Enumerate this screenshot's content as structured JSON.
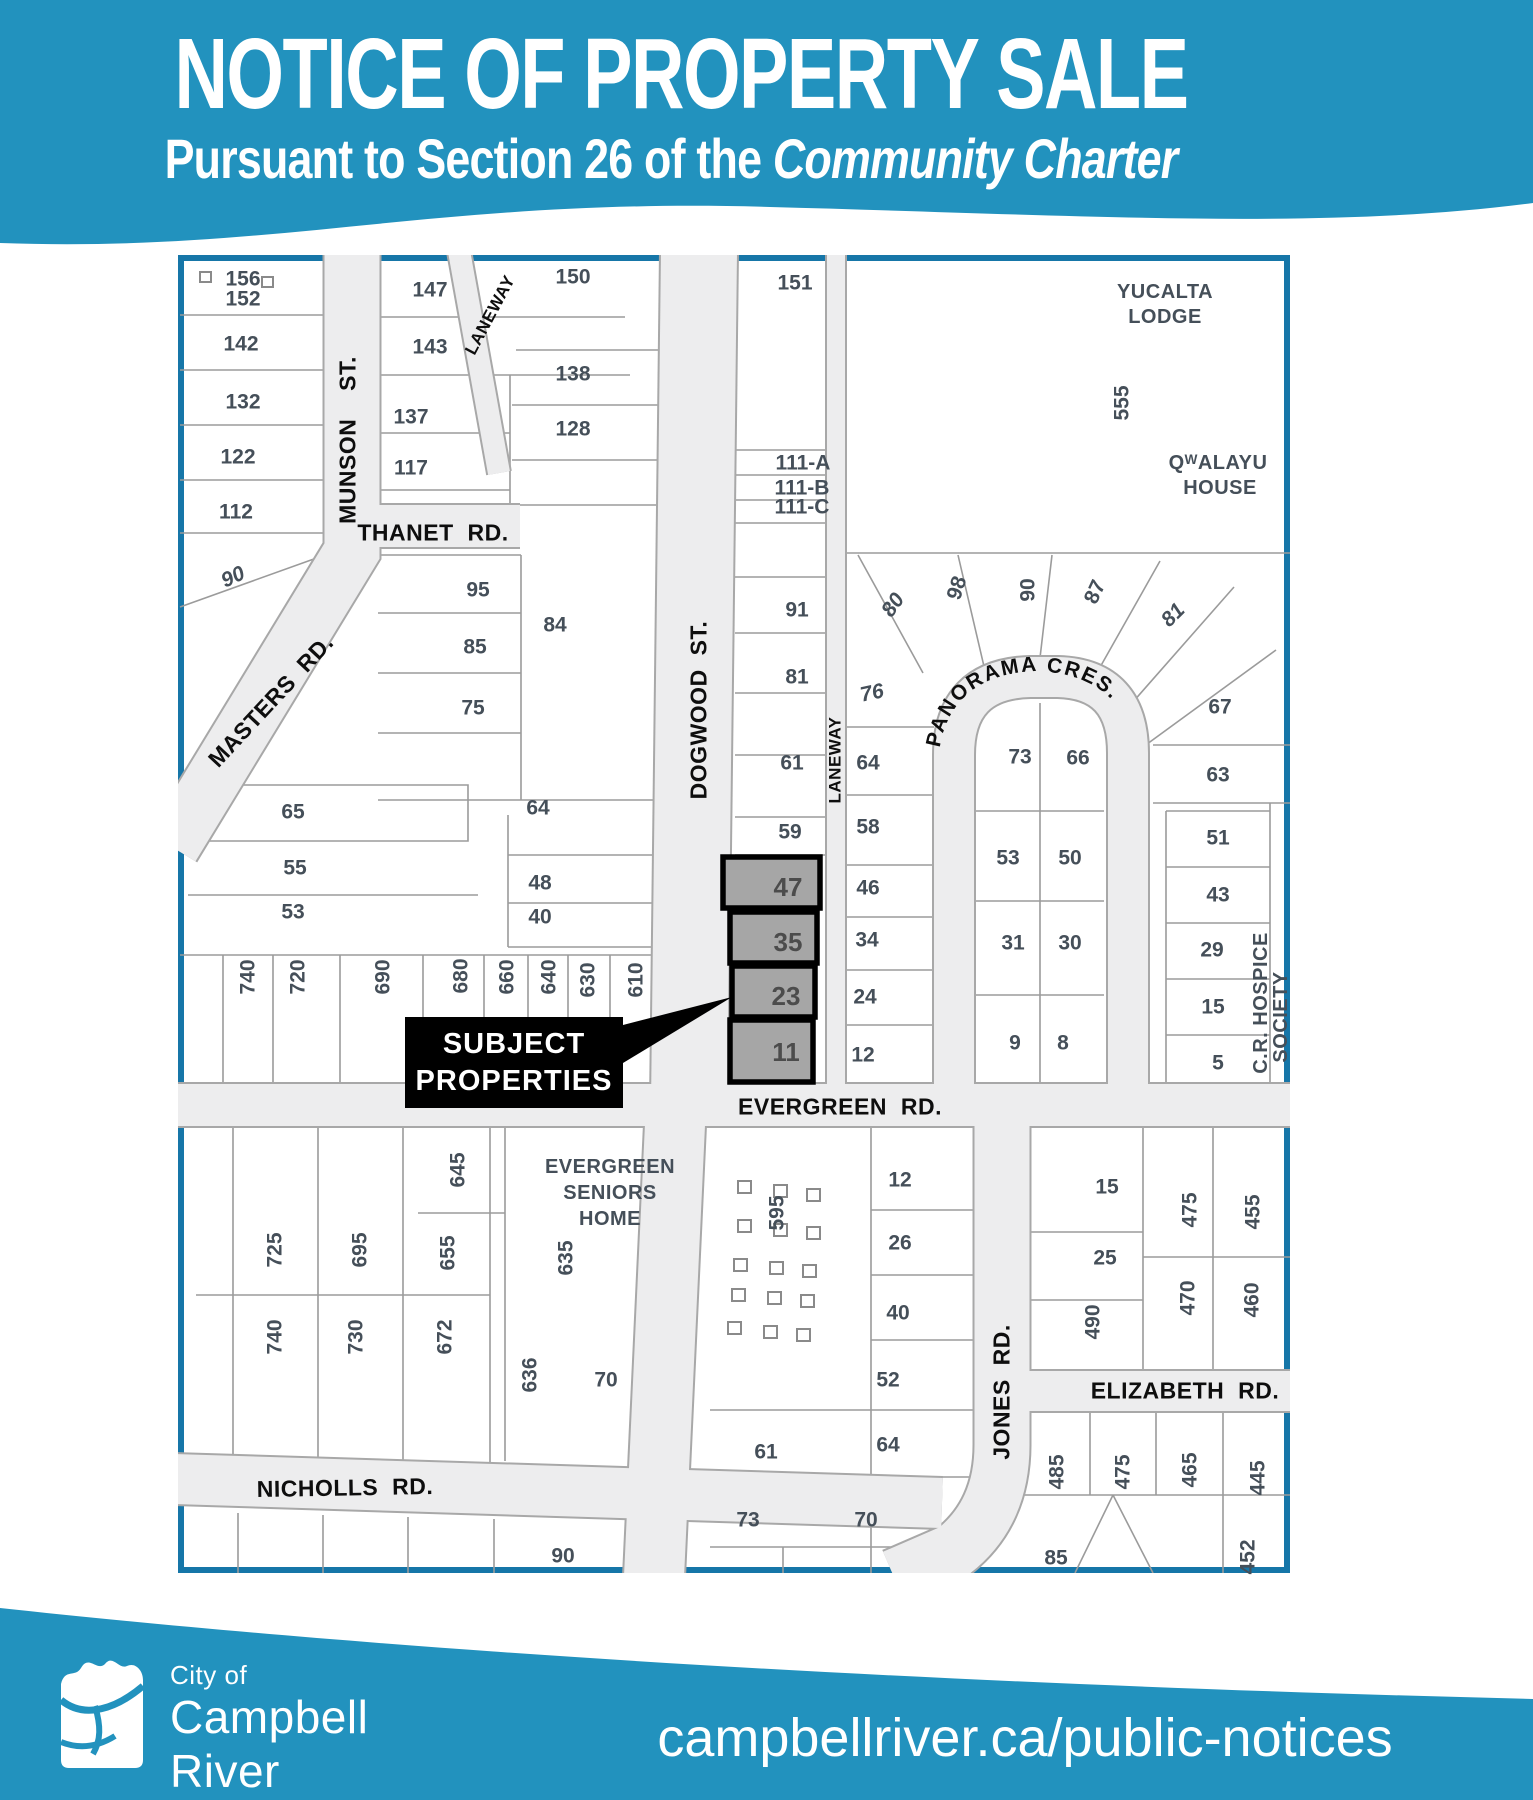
{
  "header": {
    "title": "NOTICE OF PROPERTY SALE",
    "subtitle_prefix": "Pursuant to Section 26 of the ",
    "subtitle_italic": "Community Charter"
  },
  "colors": {
    "teal": "#2292be",
    "map_border": "#1676a8",
    "street_fill": "#ededee",
    "subject_fill": "#a6a6a6",
    "lot_number_color": "#454f59"
  },
  "map": {
    "callout": {
      "line1": "SUBJECT",
      "line2": "PROPERTIES"
    },
    "panorama_label": "PANORAMA CRES.",
    "subject_lot_numbers": [
      "47",
      "35",
      "23",
      "11"
    ],
    "labels": [
      {
        "text": "MUNSON  ST.",
        "x": 170,
        "y": 185,
        "rot": -90,
        "kind": "street"
      },
      {
        "text": "LANEWAY",
        "x": 312,
        "y": 60,
        "rot": -62,
        "kind": "streetsm"
      },
      {
        "text": "THANET RD.",
        "x": 255,
        "y": 278,
        "kind": "street"
      },
      {
        "text": "MASTERS RD.",
        "x": 93,
        "y": 446,
        "rot": -47,
        "kind": "street"
      },
      {
        "text": "DOGWOOD ST.",
        "x": 521,
        "y": 455,
        "rot": -90,
        "kind": "street"
      },
      {
        "text": "LANEWAY",
        "x": 657,
        "y": 505,
        "rot": -90,
        "kind": "streetsm"
      },
      {
        "text": "EVERGREEN RD.",
        "x": 662,
        "y": 852,
        "kind": "street"
      },
      {
        "text": "NICHOLLS RD.",
        "x": 167,
        "y": 1233,
        "rot": -1,
        "kind": "street"
      },
      {
        "text": "JONES RD.",
        "x": 824,
        "y": 1137,
        "rot": -90,
        "kind": "street"
      },
      {
        "text": "ELIZABETH RD.",
        "x": 1007,
        "y": 1136,
        "kind": "street"
      },
      {
        "text": "YUCALTA",
        "x": 987,
        "y": 37,
        "kind": "landmark"
      },
      {
        "text": "LODGE",
        "x": 987,
        "y": 62,
        "kind": "landmark"
      },
      {
        "text": "QᵂALAYU",
        "x": 1040,
        "y": 208,
        "kind": "landmark"
      },
      {
        "text": "HOUSE",
        "x": 1042,
        "y": 233,
        "kind": "landmark"
      },
      {
        "text": "EVERGREEN",
        "x": 432,
        "y": 912,
        "kind": "landmark"
      },
      {
        "text": "SENIORS",
        "x": 432,
        "y": 938,
        "kind": "landmark"
      },
      {
        "text": "HOME",
        "x": 432,
        "y": 964,
        "kind": "landmark"
      },
      {
        "text": "C.R. HOSPICE",
        "x": 1083,
        "y": 748,
        "rot": -90,
        "kind": "landmark"
      },
      {
        "text": "SOCIETY",
        "x": 1103,
        "y": 762,
        "rot": -90,
        "kind": "landmark"
      },
      {
        "text": "156",
        "x": 65,
        "y": 24,
        "kind": "lot"
      },
      {
        "text": "152",
        "x": 65,
        "y": 44,
        "kind": "lot"
      },
      {
        "text": "142",
        "x": 63,
        "y": 89,
        "kind": "lot"
      },
      {
        "text": "132",
        "x": 65,
        "y": 147,
        "kind": "lot"
      },
      {
        "text": "122",
        "x": 60,
        "y": 202,
        "kind": "lot"
      },
      {
        "text": "112",
        "x": 58,
        "y": 257,
        "kind": "lot"
      },
      {
        "text": "90",
        "x": 55,
        "y": 322,
        "rot": -25,
        "kind": "ilot"
      },
      {
        "text": "147",
        "x": 252,
        "y": 35,
        "kind": "lot"
      },
      {
        "text": "143",
        "x": 252,
        "y": 92,
        "kind": "lot"
      },
      {
        "text": "137",
        "x": 233,
        "y": 162,
        "kind": "lot"
      },
      {
        "text": "117",
        "x": 233,
        "y": 213,
        "kind": "lot"
      },
      {
        "text": "150",
        "x": 395,
        "y": 22,
        "kind": "lot"
      },
      {
        "text": "138",
        "x": 395,
        "y": 119,
        "kind": "lot"
      },
      {
        "text": "128",
        "x": 395,
        "y": 174,
        "kind": "lot"
      },
      {
        "text": "151",
        "x": 617,
        "y": 28,
        "kind": "lot"
      },
      {
        "text": "111-A",
        "x": 625,
        "y": 208,
        "kind": "lot"
      },
      {
        "text": "111-B",
        "x": 624,
        "y": 233,
        "kind": "lot"
      },
      {
        "text": "111-C",
        "x": 624,
        "y": 252,
        "kind": "lot"
      },
      {
        "text": "555",
        "x": 944,
        "y": 148,
        "rot": -90,
        "kind": "lot"
      },
      {
        "text": "95",
        "x": 300,
        "y": 335,
        "kind": "lot"
      },
      {
        "text": "85",
        "x": 297,
        "y": 392,
        "kind": "lot"
      },
      {
        "text": "75",
        "x": 295,
        "y": 453,
        "kind": "lot"
      },
      {
        "text": "84",
        "x": 377,
        "y": 370,
        "kind": "lot"
      },
      {
        "text": "65",
        "x": 115,
        "y": 557,
        "kind": "lot"
      },
      {
        "text": "55",
        "x": 117,
        "y": 613,
        "kind": "lot"
      },
      {
        "text": "53",
        "x": 115,
        "y": 657,
        "kind": "lot"
      },
      {
        "text": "64",
        "x": 360,
        "y": 553,
        "kind": "lot"
      },
      {
        "text": "48",
        "x": 362,
        "y": 628,
        "kind": "lot"
      },
      {
        "text": "40",
        "x": 362,
        "y": 662,
        "kind": "lot"
      },
      {
        "text": "91",
        "x": 619,
        "y": 355,
        "kind": "lot"
      },
      {
        "text": "81",
        "x": 619,
        "y": 422,
        "kind": "lot"
      },
      {
        "text": "61",
        "x": 614,
        "y": 508,
        "kind": "lot"
      },
      {
        "text": "59",
        "x": 612,
        "y": 577,
        "kind": "lot"
      },
      {
        "text": "80",
        "x": 715,
        "y": 350,
        "rot": -55,
        "kind": "ilot"
      },
      {
        "text": "76",
        "x": 694,
        "y": 438,
        "rot": -12,
        "kind": "ilot"
      },
      {
        "text": "64",
        "x": 690,
        "y": 508,
        "kind": "lot"
      },
      {
        "text": "58",
        "x": 690,
        "y": 572,
        "kind": "lot"
      },
      {
        "text": "46",
        "x": 690,
        "y": 633,
        "kind": "lot"
      },
      {
        "text": "34",
        "x": 689,
        "y": 685,
        "kind": "lot"
      },
      {
        "text": "24",
        "x": 687,
        "y": 742,
        "kind": "lot"
      },
      {
        "text": "12",
        "x": 685,
        "y": 800,
        "kind": "lot"
      },
      {
        "text": "47",
        "x": 610,
        "y": 632,
        "kind": "subject"
      },
      {
        "text": "35",
        "x": 610,
        "y": 687,
        "kind": "subject"
      },
      {
        "text": "23",
        "x": 608,
        "y": 741,
        "kind": "subject"
      },
      {
        "text": "11",
        "x": 608,
        "y": 797,
        "kind": "subject"
      },
      {
        "text": "98",
        "x": 779,
        "y": 333,
        "rot": -72,
        "kind": "lot"
      },
      {
        "text": "90",
        "x": 850,
        "y": 335,
        "rot": -90,
        "kind": "lot"
      },
      {
        "text": "87",
        "x": 917,
        "y": 337,
        "rot": -65,
        "kind": "lot"
      },
      {
        "text": "81",
        "x": 995,
        "y": 360,
        "rot": -45,
        "kind": "ilot"
      },
      {
        "text": "67",
        "x": 1042,
        "y": 452,
        "kind": "lot"
      },
      {
        "text": "63",
        "x": 1040,
        "y": 520,
        "kind": "lot"
      },
      {
        "text": "73",
        "x": 842,
        "y": 502,
        "kind": "lot"
      },
      {
        "text": "66",
        "x": 900,
        "y": 503,
        "kind": "lot"
      },
      {
        "text": "53",
        "x": 830,
        "y": 603,
        "kind": "lot"
      },
      {
        "text": "50",
        "x": 892,
        "y": 603,
        "kind": "lot"
      },
      {
        "text": "31",
        "x": 835,
        "y": 688,
        "kind": "lot"
      },
      {
        "text": "30",
        "x": 892,
        "y": 688,
        "kind": "lot"
      },
      {
        "text": "9",
        "x": 837,
        "y": 788,
        "kind": "lot"
      },
      {
        "text": "8",
        "x": 885,
        "y": 788,
        "kind": "lot"
      },
      {
        "text": "51",
        "x": 1040,
        "y": 583,
        "kind": "lot"
      },
      {
        "text": "43",
        "x": 1040,
        "y": 640,
        "kind": "lot"
      },
      {
        "text": "29",
        "x": 1034,
        "y": 695,
        "kind": "lot"
      },
      {
        "text": "15",
        "x": 1035,
        "y": 752,
        "kind": "lot"
      },
      {
        "text": "5",
        "x": 1040,
        "y": 808,
        "kind": "lot"
      },
      {
        "text": "740",
        "x": 70,
        "y": 722,
        "rot": -90,
        "kind": "lot"
      },
      {
        "text": "720",
        "x": 120,
        "y": 722,
        "rot": -90,
        "kind": "lot"
      },
      {
        "text": "690",
        "x": 205,
        "y": 722,
        "rot": -90,
        "kind": "lot"
      },
      {
        "text": "680",
        "x": 283,
        "y": 721,
        "rot": -90,
        "kind": "lot"
      },
      {
        "text": "660",
        "x": 329,
        "y": 722,
        "rot": -90,
        "kind": "lot"
      },
      {
        "text": "640",
        "x": 371,
        "y": 722,
        "rot": -90,
        "kind": "lot"
      },
      {
        "text": "630",
        "x": 410,
        "y": 725,
        "rot": -90,
        "kind": "lot"
      },
      {
        "text": "610",
        "x": 458,
        "y": 725,
        "rot": -90,
        "kind": "lot"
      },
      {
        "text": "645",
        "x": 280,
        "y": 915,
        "rot": -90,
        "kind": "lot"
      },
      {
        "text": "635",
        "x": 388,
        "y": 1003,
        "rot": -90,
        "kind": "lot"
      },
      {
        "text": "725",
        "x": 97,
        "y": 995,
        "rot": -90,
        "kind": "lot"
      },
      {
        "text": "695",
        "x": 182,
        "y": 995,
        "rot": -90,
        "kind": "lot"
      },
      {
        "text": "655",
        "x": 270,
        "y": 998,
        "rot": -90,
        "kind": "lot"
      },
      {
        "text": "740",
        "x": 97,
        "y": 1082,
        "rot": -90,
        "kind": "lot"
      },
      {
        "text": "730",
        "x": 178,
        "y": 1082,
        "rot": -90,
        "kind": "lot"
      },
      {
        "text": "672",
        "x": 267,
        "y": 1082,
        "rot": -90,
        "kind": "lot"
      },
      {
        "text": "636",
        "x": 352,
        "y": 1120,
        "rot": -90,
        "kind": "lot"
      },
      {
        "text": "70",
        "x": 428,
        "y": 1125,
        "kind": "lot"
      },
      {
        "text": "90",
        "x": 385,
        "y": 1301,
        "kind": "lot"
      },
      {
        "text": "595",
        "x": 599,
        "y": 958,
        "rot": -90,
        "kind": "lot"
      },
      {
        "text": "12",
        "x": 722,
        "y": 925,
        "kind": "lot"
      },
      {
        "text": "26",
        "x": 722,
        "y": 988,
        "kind": "lot"
      },
      {
        "text": "40",
        "x": 720,
        "y": 1058,
        "kind": "lot"
      },
      {
        "text": "52",
        "x": 710,
        "y": 1125,
        "kind": "lot"
      },
      {
        "text": "64",
        "x": 710,
        "y": 1190,
        "kind": "lot"
      },
      {
        "text": "61",
        "x": 588,
        "y": 1197,
        "kind": "lot"
      },
      {
        "text": "73",
        "x": 570,
        "y": 1265,
        "kind": "lot"
      },
      {
        "text": "70",
        "x": 688,
        "y": 1265,
        "kind": "lot"
      },
      {
        "text": "15",
        "x": 929,
        "y": 932,
        "kind": "lot"
      },
      {
        "text": "25",
        "x": 927,
        "y": 1003,
        "kind": "lot"
      },
      {
        "text": "490",
        "x": 915,
        "y": 1067,
        "rot": -90,
        "kind": "lot"
      },
      {
        "text": "475",
        "x": 1012,
        "y": 955,
        "rot": -90,
        "kind": "lot"
      },
      {
        "text": "455",
        "x": 1075,
        "y": 957,
        "rot": -90,
        "kind": "lot"
      },
      {
        "text": "470",
        "x": 1010,
        "y": 1043,
        "rot": -90,
        "kind": "lot"
      },
      {
        "text": "460",
        "x": 1074,
        "y": 1045,
        "rot": -90,
        "kind": "lot"
      },
      {
        "text": "485",
        "x": 879,
        "y": 1217,
        "rot": -90,
        "kind": "lot"
      },
      {
        "text": "475",
        "x": 945,
        "y": 1217,
        "rot": -90,
        "kind": "lot"
      },
      {
        "text": "465",
        "x": 1012,
        "y": 1215,
        "rot": -90,
        "kind": "lot"
      },
      {
        "text": "445",
        "x": 1080,
        "y": 1223,
        "rot": -90,
        "kind": "lot"
      },
      {
        "text": "85",
        "x": 878,
        "y": 1303,
        "kind": "lot"
      },
      {
        "text": "452",
        "x": 1070,
        "y": 1302,
        "rot": -90,
        "kind": "lot"
      }
    ]
  },
  "footer": {
    "logo_small": "City of",
    "logo_line1": "Campbell",
    "logo_line2": "River",
    "url": "campbellriver.ca/public-notices"
  }
}
